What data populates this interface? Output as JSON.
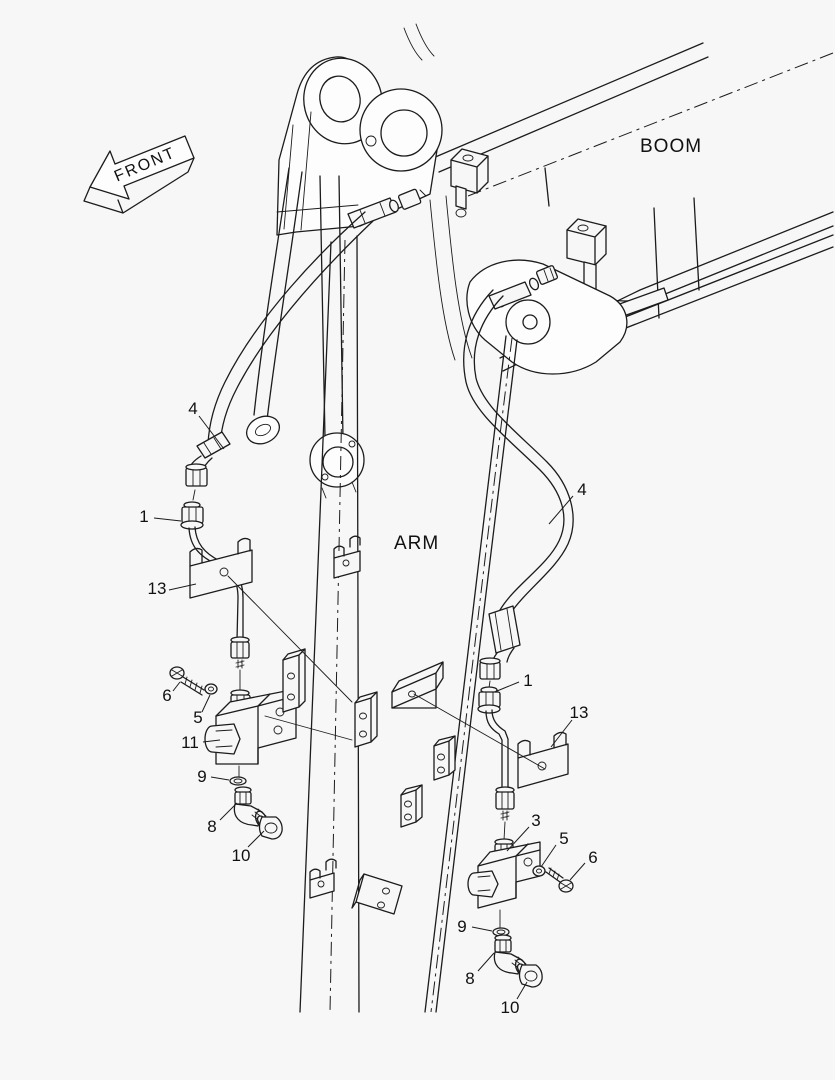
{
  "labels": {
    "front": "FRONT",
    "boom": "BOOM",
    "arm": "ARM"
  },
  "callouts": {
    "left_group": [
      {
        "label": "4"
      },
      {
        "label": "1"
      },
      {
        "label": "13"
      },
      {
        "label": "6"
      },
      {
        "label": "5"
      },
      {
        "label": "11"
      },
      {
        "label": "9"
      },
      {
        "label": "8"
      },
      {
        "label": "10"
      }
    ],
    "right_group": [
      {
        "label": "4"
      },
      {
        "label": "1"
      },
      {
        "label": "13"
      },
      {
        "label": "3"
      },
      {
        "label": "5"
      },
      {
        "label": "6"
      },
      {
        "label": "9"
      },
      {
        "label": "8"
      },
      {
        "label": "10"
      }
    ]
  },
  "colors": {
    "line": "#1c1c1c",
    "background": "#f7f7f7"
  }
}
